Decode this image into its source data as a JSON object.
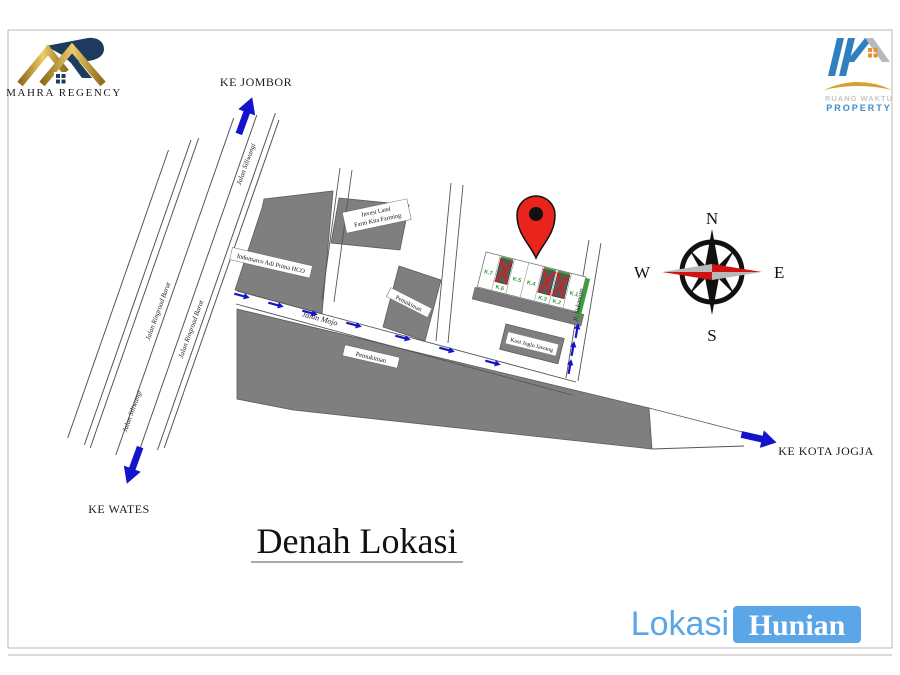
{
  "brand_left": {
    "name": "MAHRA REGENCY"
  },
  "brand_right": {
    "line1": "RUANG WAKTU",
    "line2": "PROPERTY"
  },
  "title": {
    "text": "Denah Lokasi"
  },
  "footer_brand": {
    "lokasi": "Lokasi",
    "hunian": "Hunian"
  },
  "map": {
    "directions": {
      "north": "KE JOMBOR",
      "south": "KE WATES",
      "east": "KE KOTA JOGJA"
    },
    "roads": {
      "siliwangi": "Jalan Siliwangi",
      "ringroad": "Jalan Ringroad Barat",
      "mojo": "Jalan Mojo",
      "side": "Jl. Sidomoyo"
    },
    "places": {
      "indomarco": "Indomarco Adi Prima HCO",
      "landfarm_line1": "Invest Land",
      "landfarm_line2": "Farm Kita Farming",
      "settlement_a": "Pemukiman",
      "settlement_b": "Pemukiman",
      "kost": "Kost Joglo Jawang"
    },
    "lots": [
      {
        "label": "K.7"
      },
      {
        "label": "K.6"
      },
      {
        "label": "K.5"
      },
      {
        "label": "K.4"
      },
      {
        "label": "K.3"
      },
      {
        "label": "K.2"
      },
      {
        "label": "K.1"
      }
    ],
    "compass": {
      "n": "N",
      "e": "E",
      "s": "S",
      "w": "W"
    },
    "colors": {
      "arrow_blue": "#1414cc",
      "pin_red": "#e8241c",
      "building_gray": "#7f7f7f",
      "accent_blue": "#5aa6e8",
      "logo_gold": "#c9a13a",
      "logo_navy": "#1e3a5f"
    }
  }
}
